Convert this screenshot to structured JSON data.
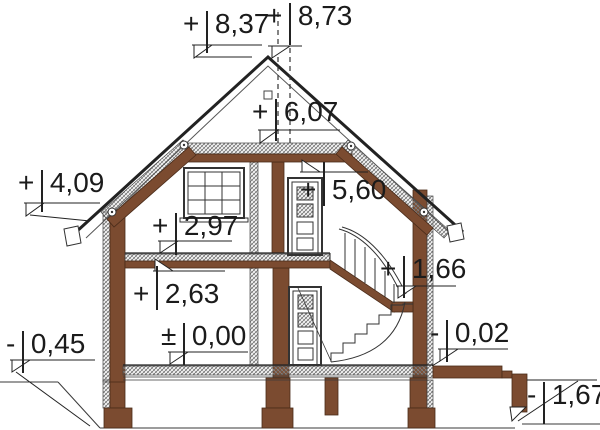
{
  "drawing": {
    "type": "house cross-section elevation drawing",
    "colors": {
      "wood": "#7b4b30",
      "line": "#222222",
      "hatch": "#6d6d6d",
      "background": "#ffffff"
    },
    "levels": [
      {
        "id": "ridge",
        "sign": "+",
        "value": "8,37"
      },
      {
        "id": "chimney-top",
        "sign": "+",
        "value": "8,73"
      },
      {
        "id": "attic-ceiling-top",
        "sign": "+",
        "value": "6,07"
      },
      {
        "id": "attic-ceiling",
        "sign": "+",
        "value": "5,60"
      },
      {
        "id": "eaves",
        "sign": "+",
        "value": "4,09"
      },
      {
        "id": "first-floor-top",
        "sign": "+",
        "value": "2,97"
      },
      {
        "id": "ground-ceiling",
        "sign": "+",
        "value": "2,63"
      },
      {
        "id": "stair-landing",
        "sign": "+",
        "value": "1,66"
      },
      {
        "id": "ground-floor",
        "sign": "±",
        "value": "0,00"
      },
      {
        "id": "grade-left",
        "sign": "-",
        "value": "0,45"
      },
      {
        "id": "terrace",
        "sign": "-",
        "value": "0,02"
      },
      {
        "id": "grade-right",
        "sign": "-",
        "value": "1,67"
      }
    ]
  }
}
